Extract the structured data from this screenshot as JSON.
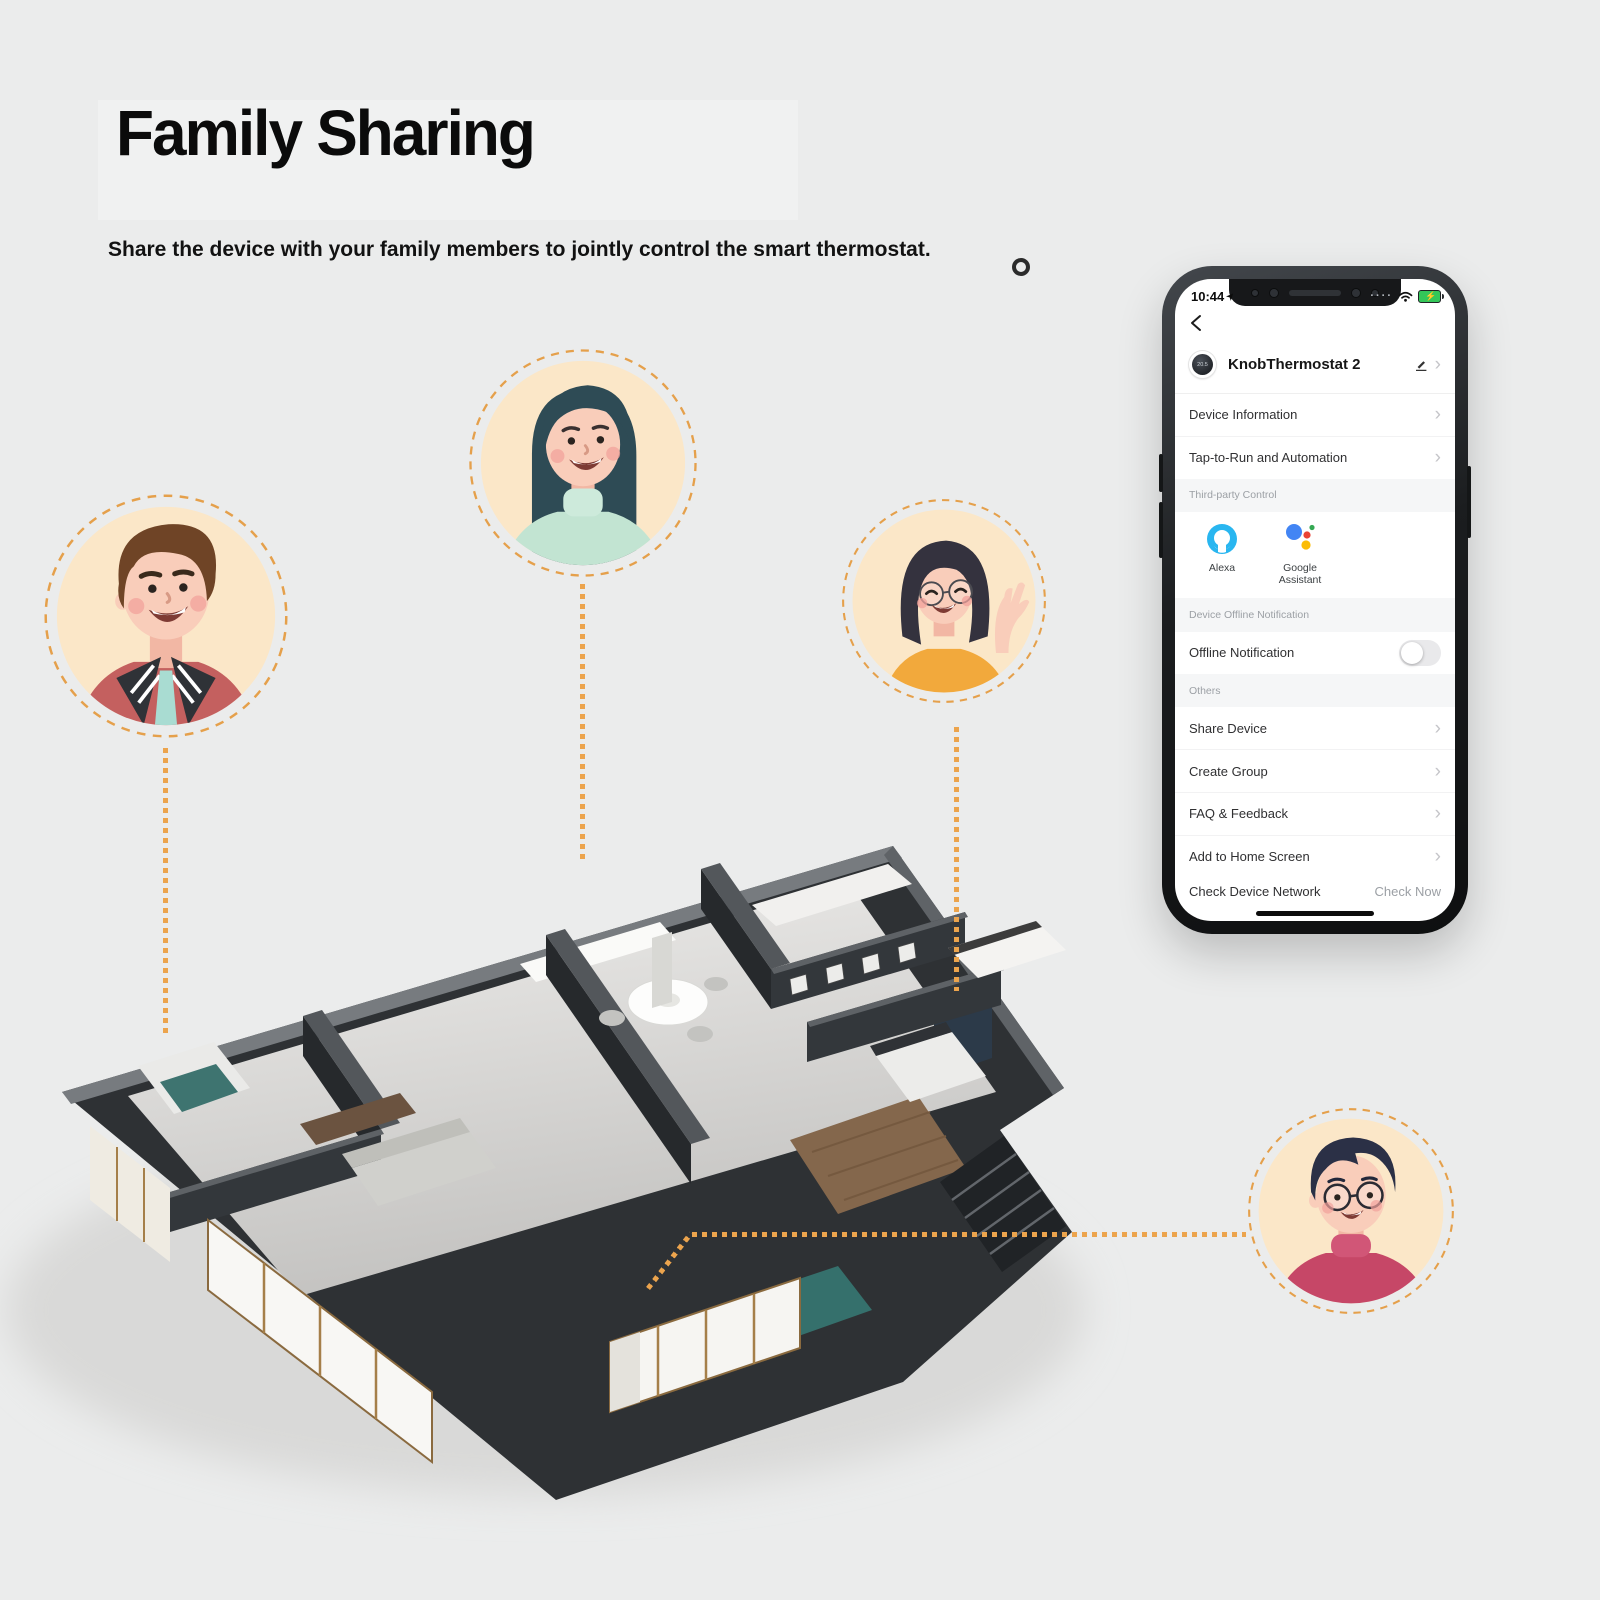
{
  "header": {
    "title": "Family Sharing",
    "subtitle": "Share the device with your family members to jointly control the smart thermostat."
  },
  "phone": {
    "status": {
      "time": "10:44"
    },
    "device": {
      "name": "KnobThermostat 2",
      "dial_value": "20.5"
    },
    "menu": {
      "device_information": "Device Information",
      "tap_to_run": "Tap-to-Run and Automation",
      "share_device": "Share Device",
      "create_group": "Create Group",
      "faq_feedback": "FAQ & Feedback",
      "add_to_home": "Add to Home Screen"
    },
    "sections": {
      "third_party": "Third-party Control",
      "offline": "Device Offline Notification",
      "others": "Others"
    },
    "third_party": {
      "alexa": "Alexa",
      "google": "Google Assistant"
    },
    "offline_row": {
      "label": "Offline Notification",
      "enabled": false
    },
    "footer": {
      "label": "Check Device Network",
      "action": "Check Now"
    }
  },
  "icons": {
    "chevron": "›",
    "back": "‹",
    "bolt": "⚡",
    "signal_dots": "····"
  },
  "illustration": {
    "avatars": [
      "man-brown-hair-red-jacket",
      "woman-long-hair-mint-sweater",
      "woman-bob-glasses-orange-top",
      "man-glasses-crimson-sweater"
    ],
    "scene": "isometric-3d-apartment-floorplan"
  },
  "colors": {
    "accent_orange": "#ECA44D",
    "avatar_bg": "#FBE7C8",
    "alexa_blue": "#29B6F0",
    "battery_green": "#34C759",
    "google_blue": "#4285F4",
    "google_red": "#EA4335",
    "google_yellow": "#FBBC05",
    "google_green": "#34A853"
  }
}
